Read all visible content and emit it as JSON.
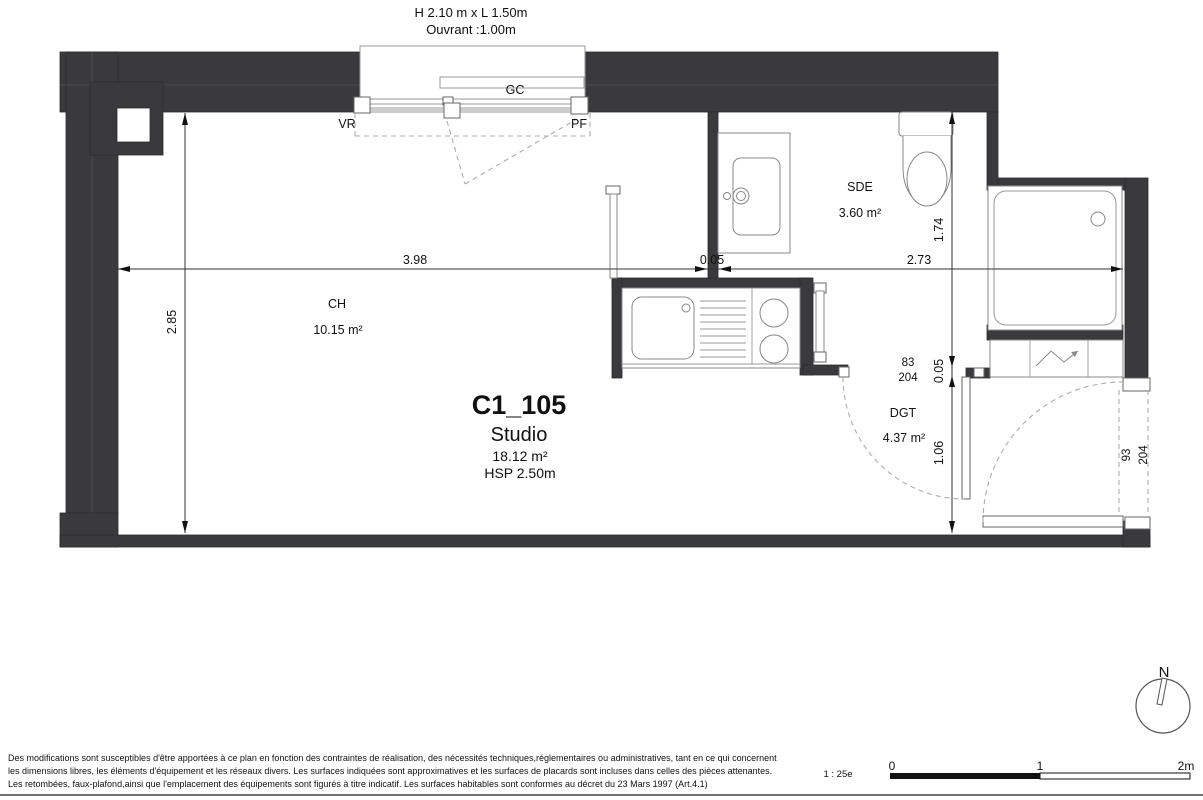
{
  "plan": {
    "window_header": {
      "line1": "H 2.10 m x  L 1.50m",
      "line2": "Ouvrant :1.00m"
    },
    "window": {
      "gc": "GC",
      "vr": "VR",
      "pf": "PF"
    },
    "unit": {
      "id": "C1_105",
      "type": "Studio",
      "area": "18.12 m²",
      "ceiling": "HSP 2.50m"
    },
    "rooms": [
      {
        "name": "CH",
        "area": "10.15 m²"
      },
      {
        "name": "SDE",
        "area": "3.60 m²"
      },
      {
        "name": "DGT",
        "area": "4.37 m²"
      }
    ],
    "dimensions": {
      "width_main": "3.98",
      "wall_h": "0.05",
      "width_right": "2.73",
      "height_main": "2.85",
      "height_sde": "1.74",
      "wall_v": "0.05",
      "height_dgt": "1.06"
    },
    "doors": {
      "interior": {
        "width": "83",
        "height": "204"
      },
      "entrance": {
        "width": "93",
        "height": "204"
      }
    },
    "compass": {
      "label": "N"
    },
    "scale": {
      "ratio": "1 : 25e",
      "tick0": "0",
      "tick1": "1",
      "tick2": "2m"
    },
    "footer": {
      "line1": "Des modifications sont susceptibles d'être apportées à ce plan en fonction des contraintes de réalisation, des nécessités techniques,réglementaires ou administratives, tant en ce qui concernent",
      "line2": "les dimensions libres, les éléments d'équipement et les réseaux divers. Les surfaces indiquées sont approximatives et les surfaces de placards sont incluses dans celles des pièces attenantes.",
      "line3": "Les retombées, faux-plafond,ainsi que l'emplacement des équipements sont figurés à titre indicatif. Les surfaces habitables sont conformes au décret du 23 Mars 1997 (Art.4.1)"
    }
  }
}
